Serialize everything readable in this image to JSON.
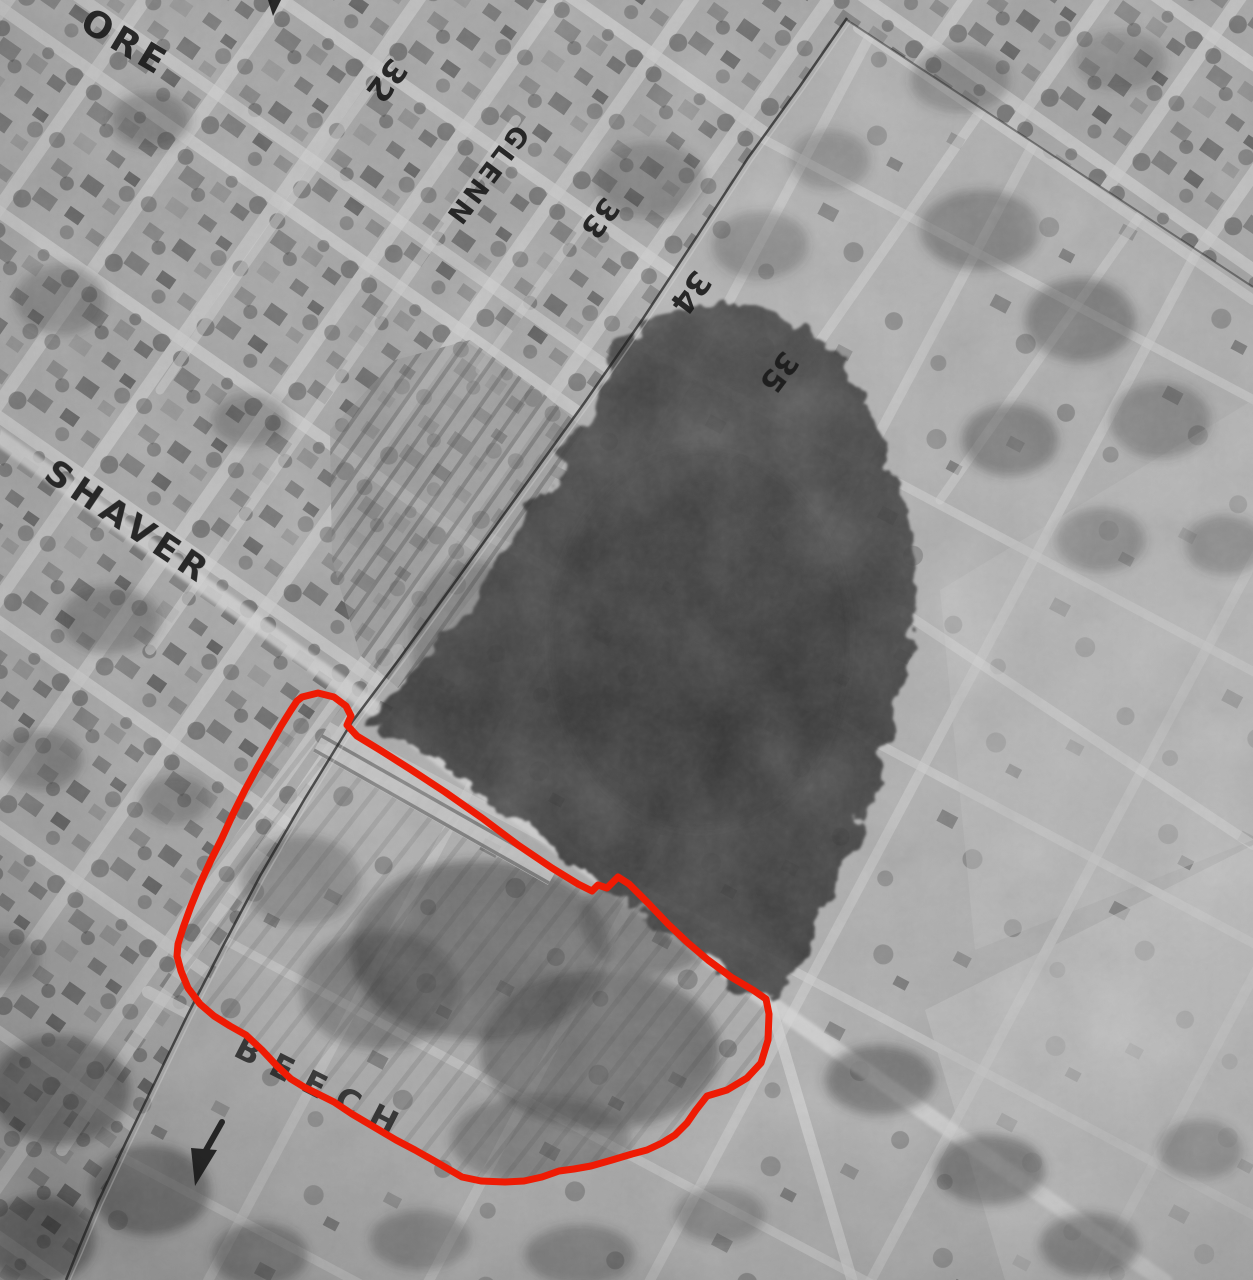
{
  "labels": {
    "partial_top_left": "ORE",
    "shaver": "SHAVER",
    "glenn": "GLENN",
    "beech": "BEECH",
    "n32": "32",
    "n33": "33",
    "n34": "34",
    "n35": "35"
  },
  "colors": {
    "outline_red": "#ee1b04",
    "ink": "#1b1b1b"
  }
}
